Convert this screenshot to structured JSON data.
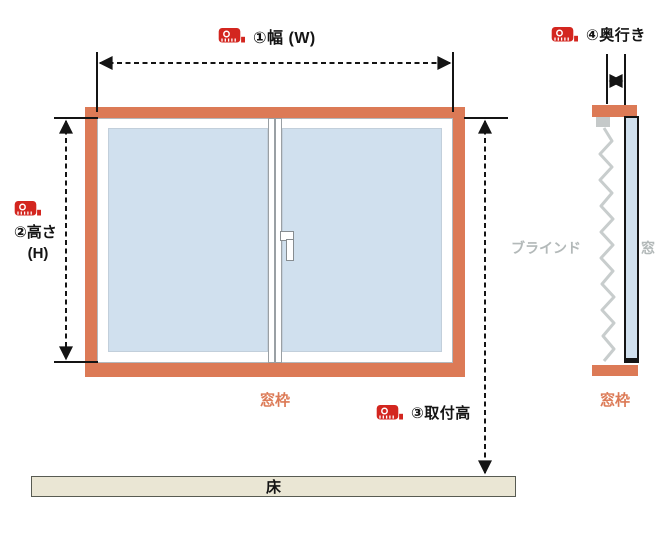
{
  "front_view": {
    "width_label": "①幅 (W)",
    "height_label": "②高さ",
    "height_suffix": "(H)",
    "mount_height_label": "③取付高",
    "frame_label": "窓枠"
  },
  "side_view": {
    "depth_label": "④奥行き",
    "blind_label": "ブラインド",
    "window_label": "窓",
    "frame_label": "窓枠"
  },
  "floor": {
    "label": "床"
  },
  "colors": {
    "frame_orange": "#dc7a56",
    "glass_blue": "#d0e0ee",
    "floor_beige": "#eae6d4",
    "label_gray": "#b3b9b9",
    "icon_red": "#d3261f",
    "line_black": "#141414",
    "slat_gray": "#c8cdcd"
  },
  "icons": {
    "tape_measure": "tape-measure-icon"
  }
}
